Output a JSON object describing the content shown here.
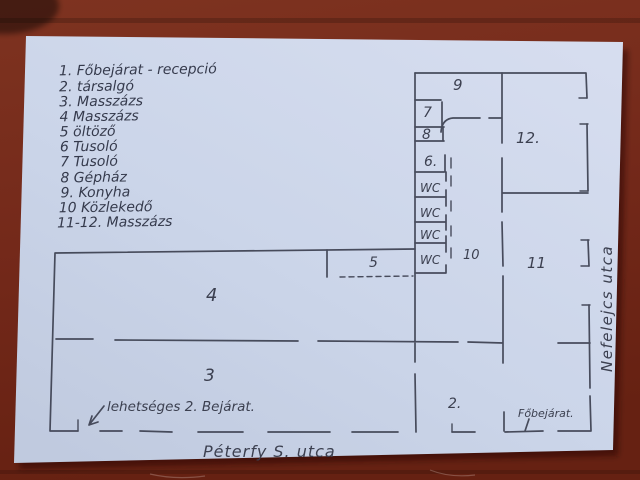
{
  "scene": {
    "table_color": "#74291a",
    "paper_color": "#cbd5e9",
    "ink_color": "#3c4050"
  },
  "legend": {
    "items": [
      "1. Főbejárat - recepció",
      "2. társalgó",
      "3. Masszázs",
      "4  Masszázs",
      "5  öltöző",
      "6  Tusoló",
      "7  Tusoló",
      "8  Gépház",
      "9. Konyha",
      "10  Közlekedő",
      "11-12.  Masszázs"
    ]
  },
  "floorplan": {
    "rooms": {
      "r2": "2.",
      "r3": "3",
      "r4": "4",
      "r5": "5",
      "r6": "6.",
      "r7": "7",
      "r8": "8",
      "r9": "9",
      "r10": "10",
      "r11": "11",
      "r12": "12.",
      "wc": "WC"
    },
    "annotations": {
      "possible_entrance": "lehetséges 2. Bejárat.",
      "main_entrance": "Főbejárat.",
      "street_bottom": "Péterfy S. utca",
      "street_right": "Nefelejcs utca"
    }
  }
}
